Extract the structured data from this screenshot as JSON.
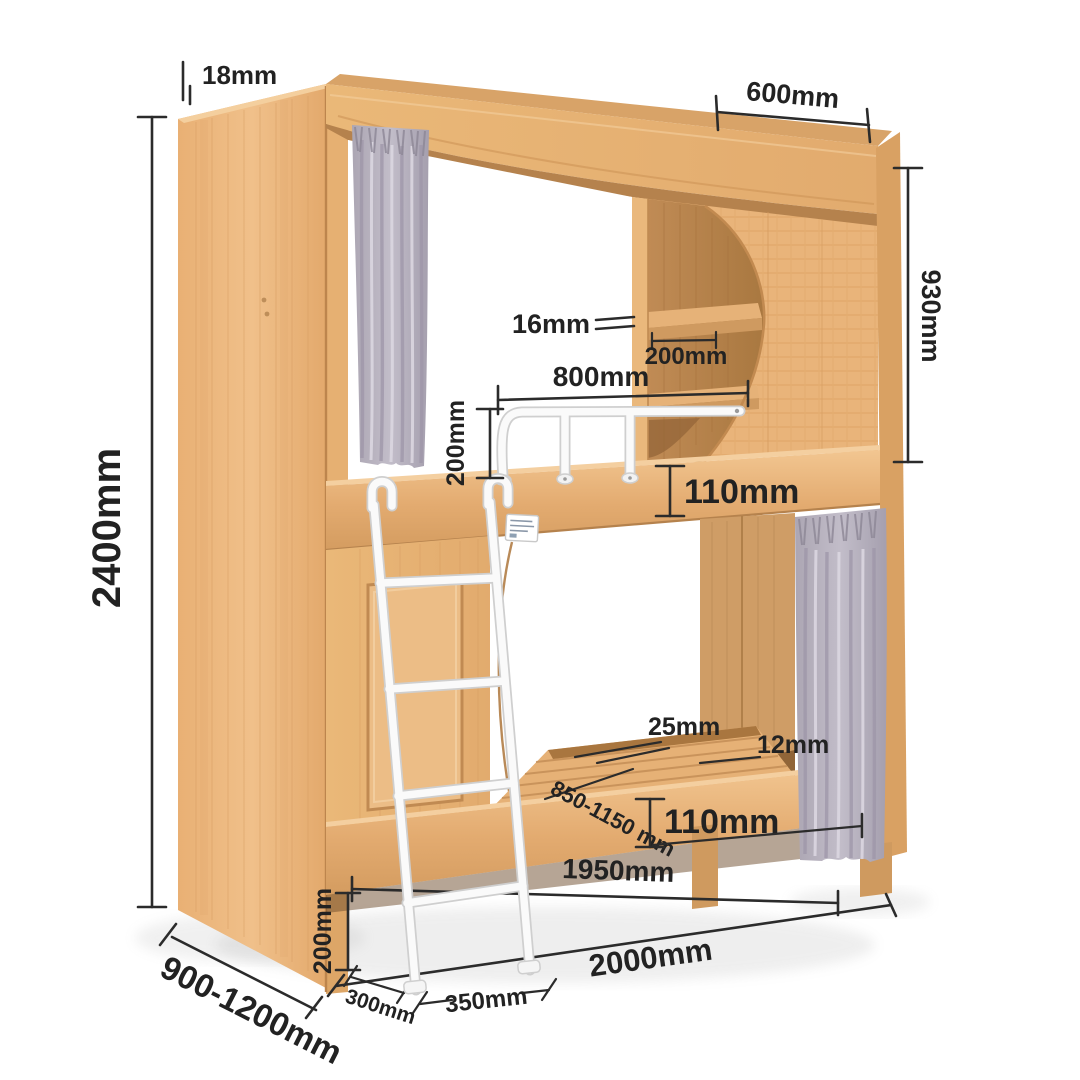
{
  "diagram": {
    "subject": "bunk-bed-dimension-diagram",
    "dims": {
      "board18": "18mm",
      "height2400": "2400mm",
      "top600": "600mm",
      "right930": "930mm",
      "shelf16": "16mm",
      "shelf200": "200mm",
      "rail800": "800mm",
      "rail200": "200mm",
      "upper110": "110mm",
      "slat25": "25mm",
      "edge12": "12mm",
      "width850": "850-1150 mm",
      "lower110": "110mm",
      "inner1950": "1950mm",
      "base200": "200mm",
      "depth900": "900-1200mm",
      "offset300": "300mm",
      "feet350": "350mm",
      "length2000": "2000mm"
    },
    "colors": {
      "wood_light": "#f0c08a",
      "wood_mid": "#e8b276",
      "wood_dark": "#b5824d",
      "wood_interior": "#b8854f",
      "curtain_base": "#b7b1bc",
      "curtain_shadow": "#968fa0",
      "curtain_light": "#d8d4dd",
      "metal_white": "#fafafa",
      "dimension_ink": "#222222",
      "background": "#ffffff"
    }
  }
}
